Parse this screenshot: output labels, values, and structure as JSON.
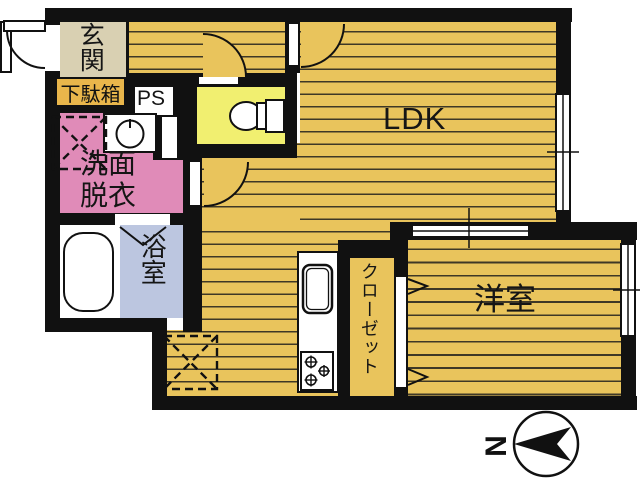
{
  "plan": {
    "entrance_label": "玄関",
    "shoe_cabinet_label": "下駄箱",
    "pipe_space_label": "PS",
    "washroom_label": "洗面\n脱衣",
    "bathroom_label": "浴室",
    "ldk_label": "LDK",
    "closet_label": "クローゼット",
    "western_room_label": "洋室",
    "compass_north_label": "N"
  },
  "colors": {
    "wall": "#111111",
    "wood_floor": "#e9c45c",
    "plank_line": "#3e3826",
    "entrance_floor": "#d9d0b2",
    "shoe_cabinet": "#e9b64b",
    "toilet_room": "#f1ef70",
    "washroom": "#e08bb8",
    "bathroom": "#bcc6e0",
    "background": "#ffffff"
  }
}
